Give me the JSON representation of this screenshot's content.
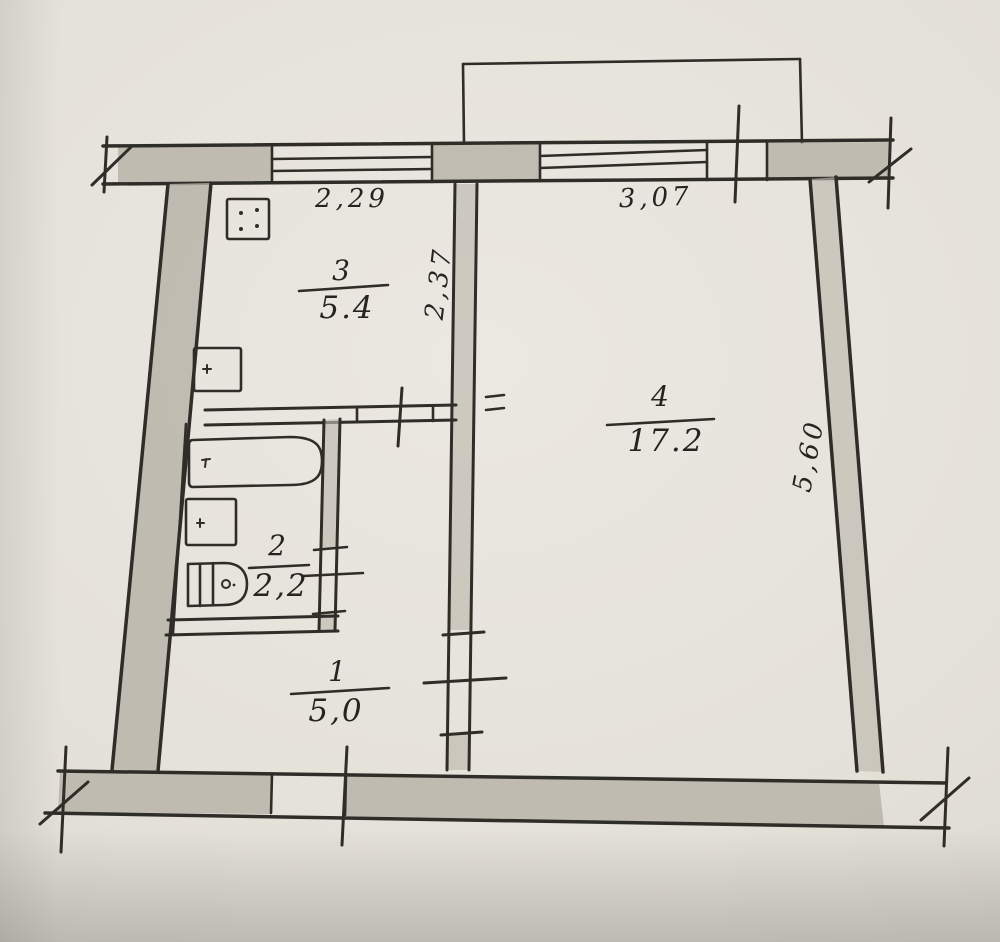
{
  "plan": {
    "rooms": [
      {
        "number": "3",
        "area": "5.4"
      },
      {
        "number": "2",
        "area": "2,2"
      },
      {
        "number": "1",
        "area": "5,0"
      },
      {
        "number": "4",
        "area": "17.2"
      }
    ],
    "dimensions": {
      "window_left": "2,29",
      "window_right": "3,07",
      "inner_vertical": "2,37",
      "right_side": "5,60"
    },
    "fixtures": [
      "stove-icon",
      "kitchen-sink-icon",
      "bathtub-icon",
      "washbasin-icon",
      "toilet-icon"
    ],
    "colors": {
      "paper": "#e7e4dc",
      "pencil": "#2f2d28",
      "wall_fill": "#b7b2a7"
    }
  }
}
